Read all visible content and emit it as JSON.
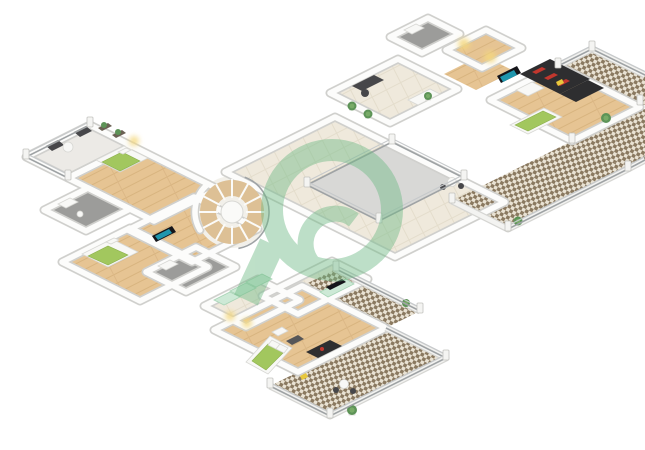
{
  "meta": {
    "title": "3D floor plan rendering",
    "description": "Isometric 3D rendered floor plan of a multi-bedroom villa upper level with a central spiral staircase, double-height void with railings, family room, three green-dressed bedrooms, walk-in closet, bathrooms and wrap-around checkered-tile terraces, over a white background with a green circular logo watermark",
    "background": "#ffffff"
  },
  "watermark": {
    "name": "property-portal-logo-watermark",
    "shape": "ring-with-curl-and-tail",
    "color": "#6fba86",
    "opacity": 0.45
  },
  "palette": {
    "wall": "#fcfcfb",
    "wall_edge": "#d0d0cd",
    "wood_floor": "#e6c493",
    "hall_tile": "#efe9dc",
    "bathroom_floor": "#9c9c9a",
    "void_floor": "#d8d8d6",
    "terrace_tile_dark": "#8a7960",
    "terrace_tile_light": "#e9e2d3",
    "bed_green": "#a2c75e",
    "sofa_dark": "#2e2e30",
    "cushion_red": "#c2372e",
    "mint_furniture": "#cde9d6",
    "plant_green": "#5d9357",
    "glow_yellow": "#f4d87f",
    "railing": "#9fa3a5"
  },
  "rooms": [
    {
      "name": "balcony-upper-left",
      "furniture": [
        "two-armchairs",
        "round-table",
        "planters",
        "railing"
      ]
    },
    {
      "name": "bedroom-1",
      "furniture": [
        "double-bed-green",
        "bedside-lamp-glow"
      ]
    },
    {
      "name": "bathroom-1",
      "furniture": [
        "vanity",
        "wc"
      ]
    },
    {
      "name": "bedroom-2",
      "furniture": [
        "double-bed-green",
        "wall-tv"
      ]
    },
    {
      "name": "bathroom-2",
      "furniture": [
        "vanity"
      ]
    },
    {
      "name": "spiral-staircase",
      "furniture": [
        "wood-treads",
        "curved-railing"
      ]
    },
    {
      "name": "gallery-hallway",
      "furniture": [
        "potted-plants",
        "console-table",
        "bistro-table-set"
      ]
    },
    {
      "name": "double-height-void",
      "furniture": [
        "perimeter-railing"
      ]
    },
    {
      "name": "study-landing",
      "furniture": [
        "desk",
        "chair",
        "console-table",
        "plants"
      ]
    },
    {
      "name": "bathroom-3",
      "furniture": [
        "vanity"
      ]
    },
    {
      "name": "dressing-corridor",
      "furniture": [
        "recessed-warm-lighting"
      ]
    },
    {
      "name": "family-room",
      "furniture": [
        "sectional-sofa-red-cushions",
        "wall-tv",
        "coffee-table",
        "daybed-green",
        "yellow-lamp"
      ]
    },
    {
      "name": "family-room-balcony",
      "furniture": [
        "railing",
        "plants",
        "checkered-tiles"
      ]
    },
    {
      "name": "master-bedroom",
      "furniture": [
        "double-bed-green",
        "white-ottoman",
        "gray-pouf",
        "dark-sofa",
        "tv-console"
      ]
    },
    {
      "name": "walk-in-closet",
      "furniture": [
        "wardrobes",
        "warm-lighting"
      ]
    },
    {
      "name": "wrap-around-terrace",
      "furniture": [
        "checkered-tiles",
        "railing",
        "bistro-table-set",
        "plants"
      ]
    }
  ]
}
